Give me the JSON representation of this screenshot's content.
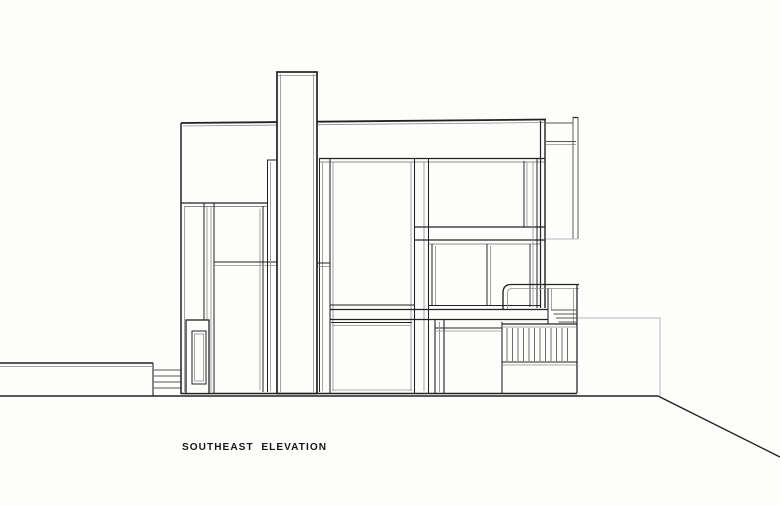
{
  "title": {
    "label": "SOUTHEAST  ELEVATION"
  },
  "drawing": {
    "width": 780,
    "height": 506,
    "colors": {
      "paper": "#fdfdfc",
      "ink": "#222222",
      "mid": "#555555",
      "light": "#8e8e8e",
      "faint": "#b8b8b8"
    },
    "elements": [
      {
        "n": "ground-line",
        "t": "line",
        "p": [
          0,
          396,
          658,
          396
        ],
        "c": "ink",
        "w": 1.5
      },
      {
        "n": "ground-slope",
        "t": "line",
        "p": [
          658,
          396,
          780,
          457
        ],
        "c": "ink",
        "w": 1.4
      },
      {
        "n": "site-wall-top",
        "t": "line",
        "p": [
          0,
          363,
          153,
          363
        ],
        "c": "ink",
        "w": 1.4
      },
      {
        "n": "site-wall-top-shadow",
        "t": "line",
        "p": [
          0,
          366.5,
          152,
          366.5
        ],
        "c": "light",
        "w": 0.8
      },
      {
        "n": "site-wall-edge",
        "t": "line",
        "p": [
          153,
          363,
          153,
          396
        ],
        "c": "ink",
        "w": 1.1
      },
      {
        "n": "entry-steps",
        "t": "multiline",
        "segs": [
          [
            154,
            370,
            181,
            370
          ],
          [
            154,
            376,
            181,
            376
          ],
          [
            154,
            382,
            181,
            382
          ],
          [
            154,
            388,
            181,
            388
          ]
        ],
        "c": "mid",
        "w": 0.9
      },
      {
        "n": "terrace-outline-faint",
        "t": "path",
        "d": "M578,318 H660 V396",
        "c": "faint",
        "w": 1
      },
      {
        "n": "roof-line",
        "t": "line",
        "p": [
          181,
          123,
          546,
          119.5
        ],
        "c": "ink",
        "w": 1.8
      },
      {
        "n": "roof-line-shadow",
        "t": "line",
        "p": [
          183,
          126,
          544,
          122.5
        ],
        "c": "light",
        "w": 0.8
      },
      {
        "n": "left-wall",
        "t": "line",
        "p": [
          181,
          123,
          181,
          394
        ],
        "c": "ink",
        "w": 1.5
      },
      {
        "n": "left-wall-inner",
        "t": "line",
        "p": [
          184.5,
          206,
          184.5,
          392
        ],
        "c": "light",
        "w": 0.8
      },
      {
        "n": "base-line",
        "t": "line",
        "p": [
          181,
          393.5,
          577,
          393.5
        ],
        "c": "ink",
        "w": 1.5
      },
      {
        "n": "wall-block-bottom",
        "t": "line",
        "p": [
          181,
          203,
          268,
          203
        ],
        "c": "ink",
        "w": 1.2
      },
      {
        "n": "window-head-left-shadow",
        "t": "line",
        "p": [
          185,
          206.5,
          268,
          206.5
        ],
        "c": "light",
        "w": 0.9
      },
      {
        "n": "left-mullion-1",
        "t": "line",
        "p": [
          204,
          203,
          204,
          393
        ],
        "c": "ink",
        "w": 1
      },
      {
        "n": "left-mullion-1-shadow",
        "t": "line",
        "p": [
          207,
          206,
          207,
          392
        ],
        "c": "light",
        "w": 0.8
      },
      {
        "n": "left-mullion-2-shadow",
        "t": "line",
        "p": [
          211,
          206,
          211,
          392
        ],
        "c": "light",
        "w": 0.8
      },
      {
        "n": "left-mullion-2",
        "t": "line",
        "p": [
          214,
          203,
          214,
          393
        ],
        "c": "ink",
        "w": 1
      },
      {
        "n": "tall-window-right-shadow",
        "t": "line",
        "p": [
          260,
          209,
          260,
          390
        ],
        "c": "light",
        "w": 0.8
      },
      {
        "n": "tall-window-right",
        "t": "line",
        "p": [
          263,
          206,
          263,
          392
        ],
        "c": "ink",
        "w": 1
      },
      {
        "n": "floor-line-left",
        "t": "line",
        "p": [
          214,
          262,
          277,
          262
        ],
        "c": "ink",
        "w": 1
      },
      {
        "n": "floor-line-left-shadow",
        "t": "line",
        "p": [
          214,
          265.5,
          277,
          265.5
        ],
        "c": "light",
        "w": 0.8
      },
      {
        "n": "slot-window-head",
        "t": "line",
        "p": [
          267,
          160,
          277,
          160
        ],
        "c": "ink",
        "w": 1
      },
      {
        "n": "slot-window-left",
        "t": "line",
        "p": [
          267.5,
          160,
          267.5,
          392
        ],
        "c": "ink",
        "w": 1
      },
      {
        "n": "slot-window-left-shadow",
        "t": "line",
        "p": [
          270.5,
          162,
          270.5,
          391
        ],
        "c": "light",
        "w": 0.8
      },
      {
        "n": "entry-door-frame",
        "t": "rect",
        "p": [
          186,
          320,
          23,
          73.5
        ],
        "c": "ink",
        "w": 1.3,
        "f": "paper"
      },
      {
        "n": "entry-door-panel",
        "t": "rect",
        "p": [
          192,
          331,
          14,
          53
        ],
        "c": "ink",
        "w": 1
      },
      {
        "n": "entry-door-panel-inner",
        "t": "rect",
        "p": [
          194.5,
          334,
          9,
          47
        ],
        "c": "light",
        "w": 0.8
      },
      {
        "n": "window-head-line",
        "t": "line",
        "p": [
          319,
          158.5,
          545,
          158.5
        ],
        "c": "ink",
        "w": 1.3
      },
      {
        "n": "window-head-shadow",
        "t": "line",
        "p": [
          319,
          162,
          545,
          162
        ],
        "c": "light",
        "w": 0.9
      },
      {
        "n": "chimney-strip-line",
        "t": "line",
        "p": [
          319.5,
          158.5,
          319.5,
          392
        ],
        "c": "ink",
        "w": 0.95
      },
      {
        "n": "chimney-strip-shadow",
        "t": "line",
        "p": [
          322.5,
          162,
          322.5,
          391
        ],
        "c": "light",
        "w": 0.8
      },
      {
        "n": "strip-floor-cap",
        "t": "line",
        "p": [
          317,
          263,
          330,
          263
        ],
        "c": "ink",
        "w": 1
      },
      {
        "n": "strip-floor-cap-shadow",
        "t": "line",
        "p": [
          317,
          266.5,
          330,
          266.5
        ],
        "c": "light",
        "w": 0.8
      },
      {
        "n": "central-jamb-left",
        "t": "line",
        "p": [
          330,
          158.5,
          330,
          393
        ],
        "c": "ink",
        "w": 1.05
      },
      {
        "n": "central-jamb-left-shadow",
        "t": "line",
        "p": [
          333,
          162,
          333,
          391
        ],
        "c": "light",
        "w": 0.8
      },
      {
        "n": "central-mullion-1-shadow",
        "t": "line",
        "p": [
          411,
          162,
          411,
          391
        ],
        "c": "light",
        "w": 0.8
      },
      {
        "n": "central-mullion-1",
        "t": "line",
        "p": [
          414.5,
          158.5,
          414.5,
          393
        ],
        "c": "ink",
        "w": 1.05
      },
      {
        "n": "central-mullion-2-shadow",
        "t": "line",
        "p": [
          424,
          162,
          424,
          391
        ],
        "c": "light",
        "w": 0.8
      },
      {
        "n": "central-mullion-2",
        "t": "line",
        "p": [
          428.5,
          158.5,
          428.5,
          393
        ],
        "c": "ink",
        "w": 1.05
      },
      {
        "n": "central-window-sill",
        "t": "line",
        "p": [
          330,
          305,
          414,
          305
        ],
        "c": "ink",
        "w": 1
      },
      {
        "n": "floor-band-top",
        "t": "line",
        "p": [
          414,
          227,
          545,
          227
        ],
        "c": "ink",
        "w": 1.2
      },
      {
        "n": "floor-band-bottom",
        "t": "line",
        "p": [
          414,
          240,
          545,
          240
        ],
        "c": "ink",
        "w": 1.2
      },
      {
        "n": "mid-window-head",
        "t": "line",
        "p": [
          429,
          244,
          540,
          244
        ],
        "c": "light",
        "w": 0.9
      },
      {
        "n": "slab-line-top",
        "t": "line",
        "p": [
          330,
          309.5,
          548,
          309.5
        ],
        "c": "ink",
        "w": 1.25
      },
      {
        "n": "slab-line-bottom",
        "t": "line",
        "p": [
          330,
          319.5,
          548,
          319.5
        ],
        "c": "ink",
        "w": 1.25
      },
      {
        "n": "mid-window-sill",
        "t": "line",
        "p": [
          429,
          305.5,
          540,
          305.5
        ],
        "c": "ink",
        "w": 0.95
      },
      {
        "n": "lower-central-head",
        "t": "line",
        "p": [
          331,
          322.5,
          412,
          322.5
        ],
        "c": "ink",
        "w": 0.95
      },
      {
        "n": "lower-central-head-shadow",
        "t": "line",
        "p": [
          332,
          325.5,
          411,
          325.5
        ],
        "c": "light",
        "w": 0.8
      },
      {
        "n": "lower-right-head",
        "t": "line",
        "p": [
          435,
          328,
          502,
          328
        ],
        "c": "ink",
        "w": 0.95
      },
      {
        "n": "lower-right-head-shadow",
        "t": "line",
        "p": [
          436,
          331,
          501,
          331
        ],
        "c": "light",
        "w": 0.8
      },
      {
        "n": "lower-central-sill-shadow",
        "t": "line",
        "p": [
          332,
          390,
          412,
          390
        ],
        "c": "light",
        "w": 0.8
      },
      {
        "n": "upper-right-window-right",
        "t": "line",
        "p": [
          524,
          161,
          524,
          227
        ],
        "c": "ink",
        "w": 0.95
      },
      {
        "n": "upper-right-window-right-shadow",
        "t": "line",
        "p": [
          527,
          162,
          527,
          226
        ],
        "c": "light",
        "w": 0.8
      },
      {
        "n": "right-mullion-shadow",
        "t": "line",
        "p": [
          533,
          162,
          533,
          307
        ],
        "c": "light",
        "w": 0.8
      },
      {
        "n": "right-mullion",
        "t": "line",
        "p": [
          537,
          158.5,
          537,
          308
        ],
        "c": "ink",
        "w": 1
      },
      {
        "n": "mid-window-divider",
        "t": "line",
        "p": [
          487,
          244,
          487,
          305
        ],
        "c": "ink",
        "w": 0.95
      },
      {
        "n": "mid-window-divider-shadow",
        "t": "line",
        "p": [
          490.5,
          246,
          490.5,
          305
        ],
        "c": "light",
        "w": 0.8
      },
      {
        "n": "mid-window2-right",
        "t": "line",
        "p": [
          530,
          244,
          530,
          307
        ],
        "c": "ink",
        "w": 0.9
      },
      {
        "n": "mid-window-jamb-upper",
        "t": "line",
        "p": [
          432,
          244,
          432,
          305
        ],
        "c": "ink",
        "w": 1
      },
      {
        "n": "mid-window-jamb-upper-shadow",
        "t": "line",
        "p": [
          435.5,
          246,
          435.5,
          305
        ],
        "c": "light",
        "w": 0.8
      },
      {
        "n": "lower-jamb-left",
        "t": "line",
        "p": [
          435,
          320,
          435,
          393
        ],
        "c": "ink",
        "w": 1.1
      },
      {
        "n": "lower-jamb-mid-shadow",
        "t": "line",
        "p": [
          439.5,
          322,
          439.5,
          392
        ],
        "c": "light",
        "w": 0.9
      },
      {
        "n": "lower-jamb-right",
        "t": "line",
        "p": [
          444,
          320,
          444,
          393
        ],
        "c": "ink",
        "w": 1.1
      },
      {
        "n": "deck-left-edge",
        "t": "line",
        "p": [
          502,
          322,
          502,
          393
        ],
        "c": "ink",
        "w": 1.05
      },
      {
        "n": "chimney",
        "t": "rect",
        "p": [
          277,
          72,
          40,
          321.5
        ],
        "c": "ink",
        "w": 1.7,
        "f": "paper"
      },
      {
        "n": "chimney-inner-left",
        "t": "line",
        "p": [
          280.5,
          74,
          280.5,
          392
        ],
        "c": "light",
        "w": 0.8
      },
      {
        "n": "chimney-inner-right",
        "t": "line",
        "p": [
          313.5,
          74,
          313.5,
          392
        ],
        "c": "light",
        "w": 0.8
      },
      {
        "n": "chimney-cap-shadow",
        "t": "line",
        "p": [
          278,
          75.5,
          316,
          75.5
        ],
        "c": "light",
        "w": 0.8
      },
      {
        "n": "parapet-beam-top",
        "t": "line",
        "p": [
          546,
          123,
          573,
          123
        ],
        "c": "mid",
        "w": 1
      },
      {
        "n": "parapet-beam-bottom",
        "t": "line",
        "p": [
          546,
          141.5,
          576,
          141.5
        ],
        "c": "mid",
        "w": 1
      },
      {
        "n": "parapet-beam-bottom-shadow",
        "t": "line",
        "p": [
          546,
          144.5,
          576,
          144.5
        ],
        "c": "light",
        "w": 0.8
      },
      {
        "n": "roof-fin-cap",
        "t": "line",
        "p": [
          572.5,
          117.5,
          578.5,
          117.5
        ],
        "c": "ink",
        "w": 1.2
      },
      {
        "n": "roof-fin-left",
        "t": "line",
        "p": [
          573,
          117.5,
          573,
          239
        ],
        "c": "mid",
        "w": 0.95
      },
      {
        "n": "roof-fin-right",
        "t": "line",
        "p": [
          578,
          117.5,
          578,
          239
        ],
        "c": "mid",
        "w": 0.95
      },
      {
        "n": "roof-fin-bottom",
        "t": "line",
        "p": [
          546,
          239,
          578,
          239
        ],
        "c": "faint",
        "w": 0.9
      },
      {
        "n": "right-wall-outer",
        "t": "line",
        "p": [
          545,
          119,
          545,
          308
        ],
        "c": "ink",
        "w": 1.4
      },
      {
        "n": "right-wall-inner",
        "t": "line",
        "p": [
          540.5,
          121,
          540.5,
          308
        ],
        "c": "ink",
        "w": 1.2
      },
      {
        "n": "deck-rail-top",
        "t": "path",
        "d": "M579,284.5 H511 Q503,284.5 503,293 V309",
        "c": "ink",
        "w": 1.35
      },
      {
        "n": "deck-rail-top-shadow",
        "t": "path",
        "d": "M579,288.5 H512 Q507.5,288.5 507.5,294 V309",
        "c": "light",
        "w": 0.85
      },
      {
        "n": "deck-rail-post-mid",
        "t": "line",
        "p": [
          548,
          288.5,
          548,
          324
        ],
        "c": "ink",
        "w": 1.05
      },
      {
        "n": "deck-rail-post-mid-shadow",
        "t": "line",
        "p": [
          551.5,
          288.5,
          551.5,
          310
        ],
        "c": "light",
        "w": 0.8
      },
      {
        "n": "deck-rail-right",
        "t": "line",
        "p": [
          577,
          284.5,
          577,
          393
        ],
        "c": "ink",
        "w": 1.25
      },
      {
        "n": "deck-rail-right-shadow",
        "t": "line",
        "p": [
          573.5,
          288.5,
          573.5,
          324
        ],
        "c": "light",
        "w": 0.8
      },
      {
        "n": "deck-steps",
        "t": "multiline",
        "segs": [
          [
            551,
            310,
            577,
            310
          ],
          [
            553.5,
            314,
            577,
            314
          ],
          [
            556,
            318,
            577,
            318
          ],
          [
            558.5,
            322,
            577,
            322
          ]
        ],
        "c": "mid",
        "w": 0.9
      },
      {
        "n": "guardrail-top",
        "t": "line",
        "p": [
          502,
          324,
          577,
          324
        ],
        "c": "ink",
        "w": 1.2
      },
      {
        "n": "guardrail-top-shadow",
        "t": "line",
        "p": [
          503,
          327,
          576,
          327
        ],
        "c": "light",
        "w": 0.8
      },
      {
        "n": "guardrail-slats",
        "t": "stripes",
        "x0": 507,
        "x1": 572.5,
        "step": 5.5,
        "y0": 328,
        "y1": 361,
        "c": "mid",
        "w": 0.85
      },
      {
        "n": "guardrail-bottom",
        "t": "line",
        "p": [
          502,
          362,
          577,
          362
        ],
        "c": "ink",
        "w": 1.1
      },
      {
        "n": "guardrail-bottom-shadow",
        "t": "line",
        "p": [
          503,
          365,
          576,
          365
        ],
        "c": "light",
        "w": 0.8
      }
    ]
  }
}
